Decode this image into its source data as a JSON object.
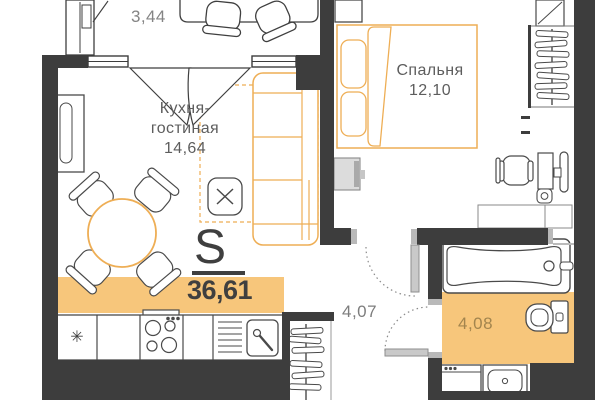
{
  "plan": {
    "type": "apartment-floor-plan",
    "total": {
      "symbol": "S",
      "value": "36,61"
    },
    "rooms": {
      "balcony": {
        "area": "3,44"
      },
      "kitchen_living": {
        "name_line1": "Кухня-",
        "name_line2": "гостиная",
        "area": "14,64"
      },
      "bedroom": {
        "name": "Спальня",
        "area": "12,10"
      },
      "hallway": {
        "area": "4,07"
      },
      "bathroom": {
        "area": "4,08"
      }
    },
    "icons": {
      "fridge_snowflake": "✳"
    },
    "colors": {
      "wall": "#3d3d3d",
      "accent_furniture_orange": "#eeae55",
      "area_highlight_orange": "#f7c67b",
      "room_label_gray": "#5d5d5d",
      "total_number_dark": "#3f3f3f",
      "bath_area_text": "#a3854e",
      "door_leaf_gray": "#c9c9c9"
    }
  }
}
